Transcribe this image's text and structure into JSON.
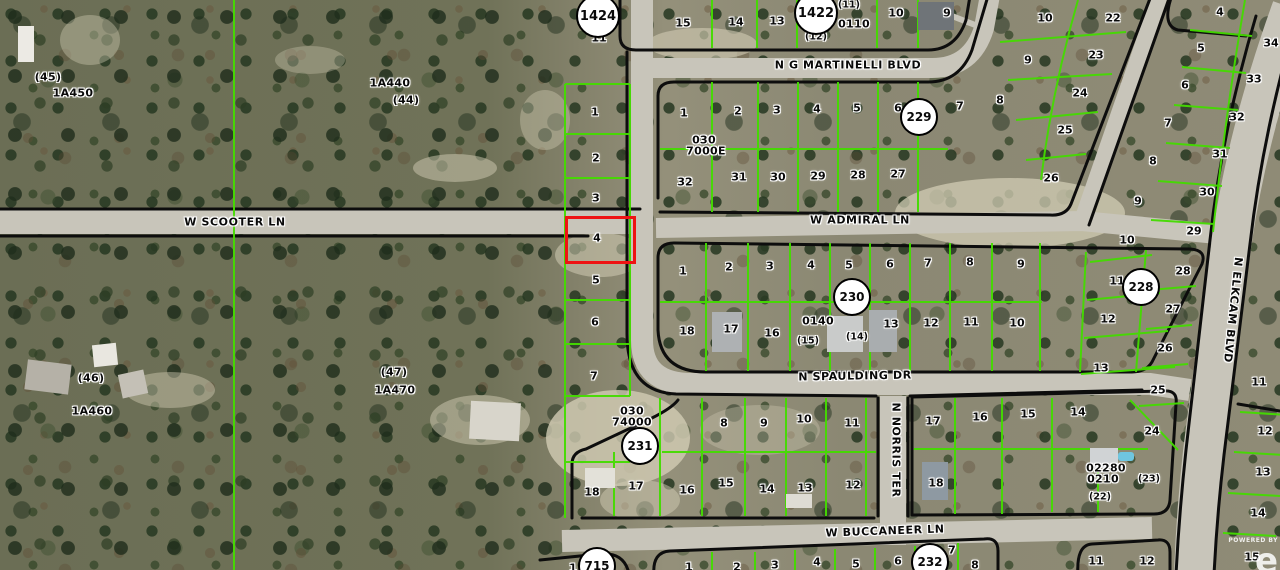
{
  "map": {
    "colors": {
      "parcel_line_green": "#44dc00",
      "plat_boundary_black": "#0d0d0d",
      "highlight_red": "#ee1313",
      "road_gray": "#c8c5ba",
      "badge_bg": "#ffffff"
    },
    "highlight": {
      "lot": "4",
      "x": 565,
      "y": 216,
      "w": 65,
      "h": 42
    },
    "streets": [
      {
        "t": "N G MARTINELLI BLVD",
        "x": 848,
        "y": 65,
        "rot": 0
      },
      {
        "t": "W SCOOTER LN",
        "x": 235,
        "y": 222,
        "rot": 0
      },
      {
        "t": "W ADMIRAL LN",
        "x": 860,
        "y": 220,
        "rot": 0
      },
      {
        "t": "N SPAULDING DR",
        "x": 855,
        "y": 376,
        "rot": -1
      },
      {
        "t": "W BUCCANEER LN",
        "x": 885,
        "y": 531,
        "rot": -2
      },
      {
        "t": "N NORRIS TER",
        "x": 896,
        "y": 450,
        "rot": 90
      },
      {
        "t": "N ELKCAM BLVD",
        "x": 1233,
        "y": 310,
        "rot": 96
      }
    ],
    "badges": [
      {
        "t": "1424",
        "x": 598,
        "y": 16,
        "r": 22
      },
      {
        "t": "1422",
        "x": 816,
        "y": 13,
        "r": 22
      },
      {
        "t": "229",
        "x": 919,
        "y": 117,
        "r": 19
      },
      {
        "t": "230",
        "x": 852,
        "y": 297,
        "r": 19
      },
      {
        "t": "228",
        "x": 1141,
        "y": 287,
        "r": 19
      },
      {
        "t": "231",
        "x": 640,
        "y": 446,
        "r": 19
      },
      {
        "t": "232",
        "x": 930,
        "y": 562,
        "r": 19
      },
      {
        "t": "715",
        "x": 597,
        "y": 566,
        "r": 19
      }
    ],
    "areas": [
      {
        "t": "(45)",
        "x": 48,
        "y": 77,
        "cls": "sm"
      },
      {
        "t": "1A450",
        "x": 73,
        "y": 93
      },
      {
        "t": "1A440",
        "x": 390,
        "y": 83
      },
      {
        "t": "(44)",
        "x": 406,
        "y": 100,
        "cls": "sm"
      },
      {
        "t": "(46)",
        "x": 91,
        "y": 378,
        "cls": "sm"
      },
      {
        "t": "1A460",
        "x": 92,
        "y": 411
      },
      {
        "t": "(47)",
        "x": 394,
        "y": 372,
        "cls": "sm"
      },
      {
        "t": "1A470",
        "x": 395,
        "y": 390
      },
      {
        "t": "030",
        "x": 704,
        "y": 140
      },
      {
        "t": "7000E",
        "x": 706,
        "y": 151
      },
      {
        "t": "030",
        "x": 632,
        "y": 411
      },
      {
        "t": "74000",
        "x": 632,
        "y": 422
      },
      {
        "t": "0110",
        "x": 854,
        "y": 24
      },
      {
        "t": "0140",
        "x": 818,
        "y": 321
      },
      {
        "t": "02280",
        "x": 1106,
        "y": 468
      },
      {
        "t": "0210",
        "x": 1103,
        "y": 479
      }
    ],
    "lots": [
      {
        "t": "11",
        "x": 599,
        "y": 38
      },
      {
        "t": "15",
        "x": 683,
        "y": 23
      },
      {
        "t": "14",
        "x": 736,
        "y": 22
      },
      {
        "t": "13",
        "x": 777,
        "y": 21
      },
      {
        "t": "(11)",
        "x": 849,
        "y": 5,
        "cls": "sm"
      },
      {
        "t": "(12)",
        "x": 816,
        "y": 37,
        "cls": "sm"
      },
      {
        "t": "10",
        "x": 896,
        "y": 13
      },
      {
        "t": "9",
        "x": 947,
        "y": 13
      },
      {
        "t": "10",
        "x": 1045,
        "y": 18
      },
      {
        "t": "22",
        "x": 1113,
        "y": 18
      },
      {
        "t": "9",
        "x": 1028,
        "y": 60
      },
      {
        "t": "23",
        "x": 1096,
        "y": 55
      },
      {
        "t": "8",
        "x": 1000,
        "y": 100
      },
      {
        "t": "24",
        "x": 1080,
        "y": 93
      },
      {
        "t": "25",
        "x": 1065,
        "y": 130
      },
      {
        "t": "26",
        "x": 1051,
        "y": 178
      },
      {
        "t": "4",
        "x": 1220,
        "y": 12
      },
      {
        "t": "34",
        "x": 1271,
        "y": 43
      },
      {
        "t": "5",
        "x": 1201,
        "y": 48
      },
      {
        "t": "33",
        "x": 1254,
        "y": 79
      },
      {
        "t": "6",
        "x": 1185,
        "y": 85
      },
      {
        "t": "32",
        "x": 1237,
        "y": 117
      },
      {
        "t": "7",
        "x": 1168,
        "y": 123
      },
      {
        "t": "31",
        "x": 1220,
        "y": 154
      },
      {
        "t": "8",
        "x": 1153,
        "y": 161
      },
      {
        "t": "30",
        "x": 1207,
        "y": 192
      },
      {
        "t": "9",
        "x": 1138,
        "y": 201
      },
      {
        "t": "29",
        "x": 1194,
        "y": 231
      },
      {
        "t": "10",
        "x": 1127,
        "y": 240
      },
      {
        "t": "28",
        "x": 1183,
        "y": 271
      },
      {
        "t": "11",
        "x": 1117,
        "y": 281
      },
      {
        "t": "27",
        "x": 1173,
        "y": 309
      },
      {
        "t": "12",
        "x": 1108,
        "y": 319
      },
      {
        "t": "26",
        "x": 1165,
        "y": 348
      },
      {
        "t": "13",
        "x": 1101,
        "y": 368
      },
      {
        "t": "25",
        "x": 1158,
        "y": 390
      },
      {
        "t": "11",
        "x": 1259,
        "y": 382
      },
      {
        "t": "1",
        "x": 595,
        "y": 112
      },
      {
        "t": "2",
        "x": 596,
        "y": 158
      },
      {
        "t": "3",
        "x": 596,
        "y": 198
      },
      {
        "t": "4",
        "x": 597,
        "y": 238
      },
      {
        "t": "5",
        "x": 596,
        "y": 280
      },
      {
        "t": "6",
        "x": 595,
        "y": 322
      },
      {
        "t": "7",
        "x": 594,
        "y": 376
      },
      {
        "t": "1",
        "x": 684,
        "y": 113
      },
      {
        "t": "2",
        "x": 738,
        "y": 111
      },
      {
        "t": "3",
        "x": 777,
        "y": 110
      },
      {
        "t": "4",
        "x": 817,
        "y": 109
      },
      {
        "t": "5",
        "x": 857,
        "y": 108
      },
      {
        "t": "6",
        "x": 898,
        "y": 108
      },
      {
        "t": "7",
        "x": 960,
        "y": 106
      },
      {
        "t": "32",
        "x": 685,
        "y": 182
      },
      {
        "t": "31",
        "x": 739,
        "y": 177
      },
      {
        "t": "30",
        "x": 778,
        "y": 177
      },
      {
        "t": "29",
        "x": 818,
        "y": 176
      },
      {
        "t": "28",
        "x": 858,
        "y": 175
      },
      {
        "t": "27",
        "x": 898,
        "y": 174
      },
      {
        "t": "1",
        "x": 683,
        "y": 271
      },
      {
        "t": "2",
        "x": 729,
        "y": 267
      },
      {
        "t": "3",
        "x": 770,
        "y": 266
      },
      {
        "t": "4",
        "x": 811,
        "y": 265
      },
      {
        "t": "5",
        "x": 849,
        "y": 265
      },
      {
        "t": "6",
        "x": 890,
        "y": 264
      },
      {
        "t": "7",
        "x": 928,
        "y": 263
      },
      {
        "t": "8",
        "x": 970,
        "y": 262
      },
      {
        "t": "9",
        "x": 1021,
        "y": 264
      },
      {
        "t": "18",
        "x": 687,
        "y": 331
      },
      {
        "t": "17",
        "x": 731,
        "y": 329
      },
      {
        "t": "16",
        "x": 772,
        "y": 333
      },
      {
        "t": "(15)",
        "x": 808,
        "y": 341,
        "cls": "sm"
      },
      {
        "t": "(14)",
        "x": 857,
        "y": 337,
        "cls": "sm"
      },
      {
        "t": "13",
        "x": 891,
        "y": 324
      },
      {
        "t": "12",
        "x": 931,
        "y": 323
      },
      {
        "t": "11",
        "x": 971,
        "y": 322
      },
      {
        "t": "10",
        "x": 1017,
        "y": 323
      },
      {
        "t": "8",
        "x": 724,
        "y": 423
      },
      {
        "t": "9",
        "x": 764,
        "y": 423
      },
      {
        "t": "10",
        "x": 804,
        "y": 419
      },
      {
        "t": "11",
        "x": 852,
        "y": 423
      },
      {
        "t": "18",
        "x": 592,
        "y": 492
      },
      {
        "t": "17",
        "x": 636,
        "y": 486
      },
      {
        "t": "16",
        "x": 687,
        "y": 490
      },
      {
        "t": "15",
        "x": 726,
        "y": 483
      },
      {
        "t": "14",
        "x": 767,
        "y": 489
      },
      {
        "t": "13",
        "x": 805,
        "y": 488
      },
      {
        "t": "12",
        "x": 853,
        "y": 485
      },
      {
        "t": "17",
        "x": 933,
        "y": 421
      },
      {
        "t": "16",
        "x": 980,
        "y": 417
      },
      {
        "t": "15",
        "x": 1028,
        "y": 414
      },
      {
        "t": "14",
        "x": 1078,
        "y": 412
      },
      {
        "t": "18",
        "x": 936,
        "y": 483
      },
      {
        "t": "24",
        "x": 1152,
        "y": 431
      },
      {
        "t": "(23)",
        "x": 1149,
        "y": 479,
        "cls": "sm"
      },
      {
        "t": "(22)",
        "x": 1100,
        "y": 497,
        "cls": "sm"
      },
      {
        "t": "12",
        "x": 1265,
        "y": 431
      },
      {
        "t": "13",
        "x": 1263,
        "y": 472
      },
      {
        "t": "14",
        "x": 1258,
        "y": 513
      },
      {
        "t": "15",
        "x": 1252,
        "y": 557
      },
      {
        "t": "11",
        "x": 1096,
        "y": 561
      },
      {
        "t": "12",
        "x": 1147,
        "y": 561
      },
      {
        "t": "1",
        "x": 573,
        "y": 568
      },
      {
        "t": "1",
        "x": 689,
        "y": 567
      },
      {
        "t": "2",
        "x": 737,
        "y": 567
      },
      {
        "t": "3",
        "x": 775,
        "y": 565
      },
      {
        "t": "4",
        "x": 817,
        "y": 562
      },
      {
        "t": "5",
        "x": 856,
        "y": 564
      },
      {
        "t": "6",
        "x": 898,
        "y": 561
      },
      {
        "t": "7",
        "x": 952,
        "y": 550
      },
      {
        "t": "8",
        "x": 975,
        "y": 565
      }
    ],
    "watermark": {
      "powered_by": "POWERED BY",
      "logo": "e"
    }
  }
}
